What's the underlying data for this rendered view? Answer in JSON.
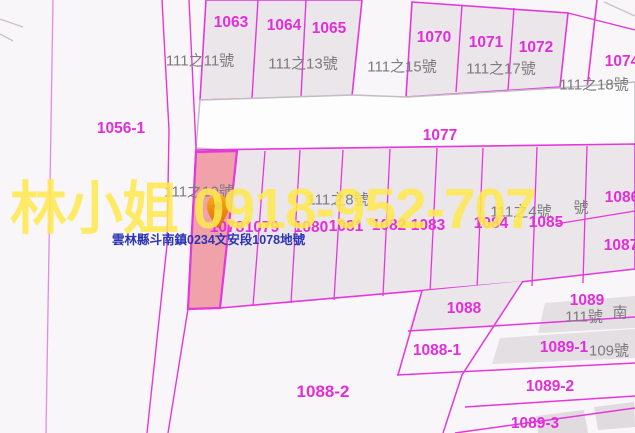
{
  "map": {
    "watermark_text": "林小姐 0918-952-707",
    "pin_label": "雲林縣斗南鎮0234文安段1078地號",
    "parcel_numbers": {
      "n1056_1": "1056-1",
      "n1063": "1063",
      "n1064": "1064",
      "n1065": "1065",
      "n1070": "1070",
      "n1071": "1071",
      "n1072": "1072",
      "n1074": "1074",
      "n1077": "1077",
      "n1078": "1078",
      "n1079": "1079",
      "n1080": "1080",
      "n1081": "1081",
      "n1082": "1082",
      "n1083": "1083",
      "n1084": "1084",
      "n1085": "1085",
      "n1086": "1086",
      "n1087": "1087",
      "n1088": "1088",
      "n1088_1": "1088-1",
      "n1088_2": "1088-2",
      "n1089": "1089",
      "n1089_1": "1089-1",
      "n1089_2": "1089-2",
      "n1089_3": "1089-3"
    },
    "addresses": {
      "no111_11": "111之11號",
      "no111_13": "111之13號",
      "no111_15": "111之15號",
      "no111_17": "111之17號",
      "no111_18": "111之18號",
      "no111_10": "111之10號",
      "no111_8": "111之8號",
      "no111_4": "111之4號",
      "no_hao_fragment": "號",
      "no111": "111號",
      "no_nan_fragment": "南",
      "no109": "109號"
    },
    "colors": {
      "boundary": "#e637dd",
      "parcel_fill": "#eae6ea",
      "selected_parcel_fill": "#f0a1aa",
      "road_fill": "#fefdfe",
      "road_casing": "#c3bcc3",
      "parcel_number_text": "#e22ed8",
      "address_text": "#7b7b7b",
      "watermark_text_color": "#ffe94f",
      "pin_color": "#f09000",
      "pin_label_color": "#2a34b4",
      "background": "#f8f6f8"
    }
  }
}
